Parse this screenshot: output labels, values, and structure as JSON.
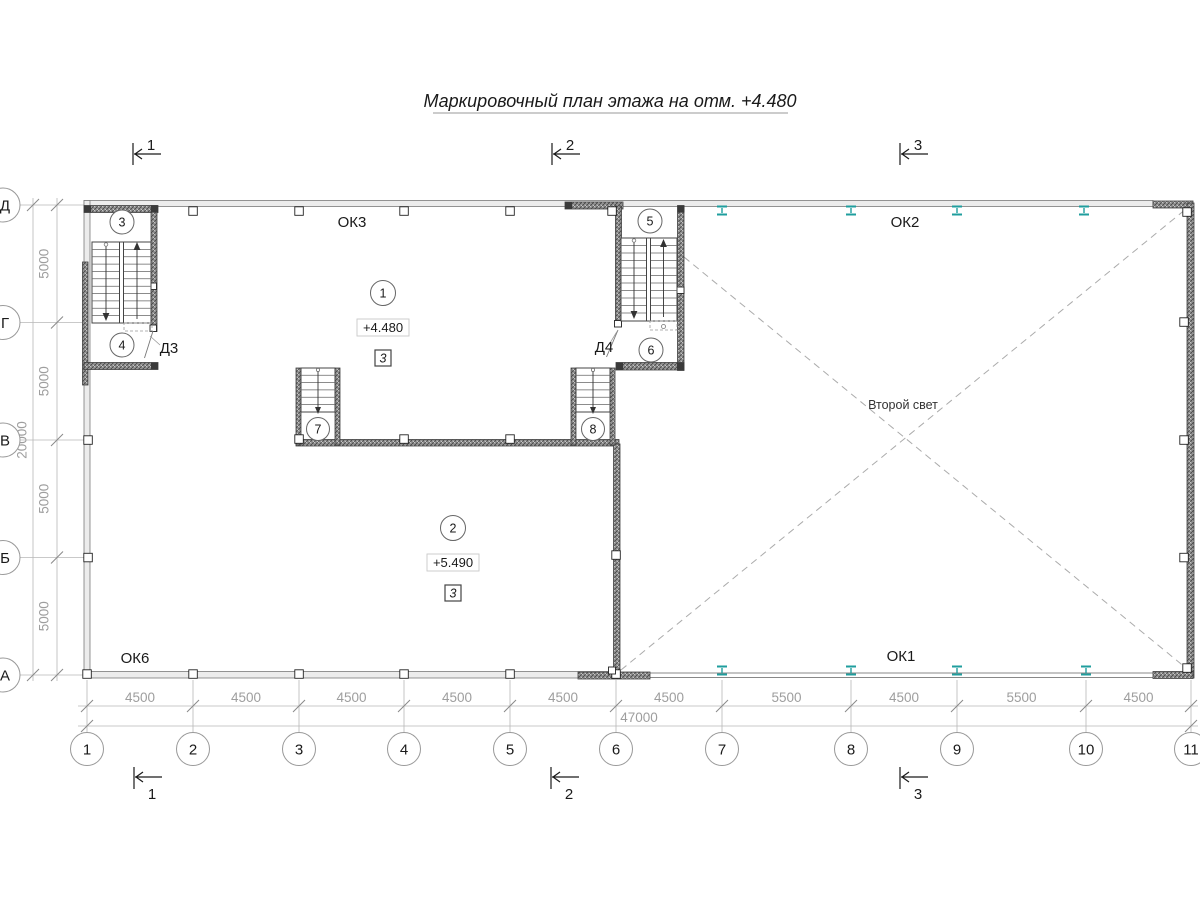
{
  "title": "Маркировочный план этажа на отм. +4.480",
  "colors": {
    "steel_column": "#1f9e9e"
  },
  "sections": {
    "s1": "1",
    "s2": "2",
    "s3": "3"
  },
  "axes": {
    "columns": [
      "1",
      "2",
      "3",
      "4",
      "5",
      "6",
      "7",
      "8",
      "9",
      "10",
      "11"
    ],
    "rows": [
      "Д",
      "Г",
      "В",
      "Б",
      "А"
    ]
  },
  "dims": {
    "col_segments": [
      "4500",
      "4500",
      "4500",
      "4500",
      "4500",
      "4500",
      "5500",
      "4500",
      "5500",
      "4500"
    ],
    "col_total": "47000",
    "row_segments": [
      "5000",
      "5000",
      "5000",
      "5000"
    ],
    "row_total": "20000"
  },
  "windows": {
    "ok1": "ОК1",
    "ok2": "ОК2",
    "ok3": "ОК3",
    "ok6": "ОК6"
  },
  "doors": {
    "d3": "Д3",
    "d4": "Д4"
  },
  "notes": {
    "second_light": "Второй свет"
  },
  "rooms": {
    "r1": {
      "number": "1",
      "elevation": "+4.480",
      "mark": "3"
    },
    "r2": {
      "number": "2",
      "elevation": "+5.490",
      "mark": "3"
    },
    "r3": {
      "number": "3"
    },
    "r4": {
      "number": "4"
    },
    "r5": {
      "number": "5"
    },
    "r6": {
      "number": "6"
    },
    "r7": {
      "number": "7"
    },
    "r8": {
      "number": "8"
    }
  }
}
